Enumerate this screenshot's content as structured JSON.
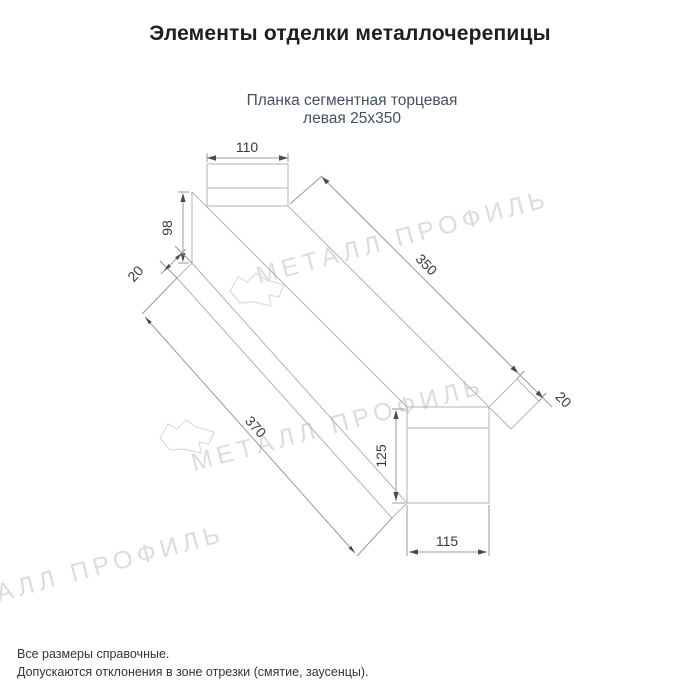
{
  "page": {
    "title": "Элементы отделки металлочерепицы"
  },
  "product": {
    "name_line1": "Планка сегментная торцевая",
    "name_line2": "левая 25х350"
  },
  "drawing": {
    "dims": {
      "top_width": "110",
      "web_height": "98",
      "left_flange": "20",
      "length_top": "350",
      "length_bottom": "370",
      "right_flange": "20",
      "end_height": "125",
      "end_width": "115"
    }
  },
  "watermark": {
    "text": "МЕТАЛЛ ПРОФИЛЬ"
  },
  "footer": {
    "line1": "Все размеры справочные.",
    "line2": "Допускаются отклонения в зоне отрезки (смятие, заусенцы)."
  },
  "colors": {
    "background": "#ffffff",
    "outline_line": "#b3b3b3",
    "dimension_text": "#3a3a3a",
    "title_text": "#1f1f1f",
    "subtitle_text": "#43505d",
    "watermark": "#dcdcdc",
    "footer_text": "#2d353f"
  }
}
